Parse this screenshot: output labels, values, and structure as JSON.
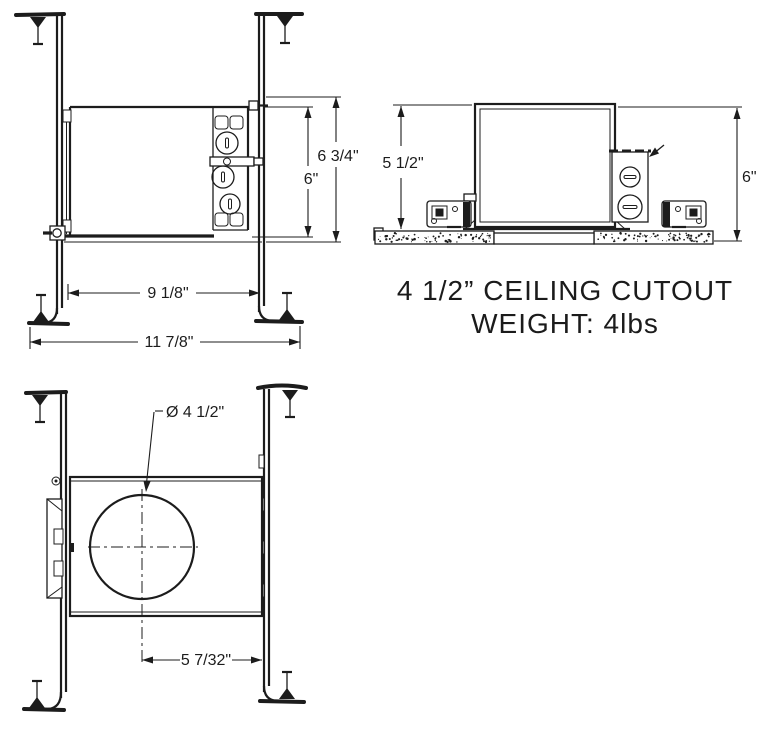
{
  "colors": {
    "ink": "#1c1c1c",
    "background": "#ffffff"
  },
  "front_view": {
    "dim_overall_height": "6 3/4\"",
    "dim_housing_height": "6\"",
    "dim_housing_width": "9 1/8\"",
    "dim_overall_width": "11 7/8\""
  },
  "side_view": {
    "dim_housing_height": "5 1/2\"",
    "dim_overall_height": "6\""
  },
  "bottom_view": {
    "dim_aperture_diameter": "Ø 4 1/2\"",
    "dim_center_offset": "5 7/32\""
  },
  "caption": {
    "line1": "4 1/2” CEILING CUTOUT",
    "line2": "WEIGHT: 4lbs"
  }
}
